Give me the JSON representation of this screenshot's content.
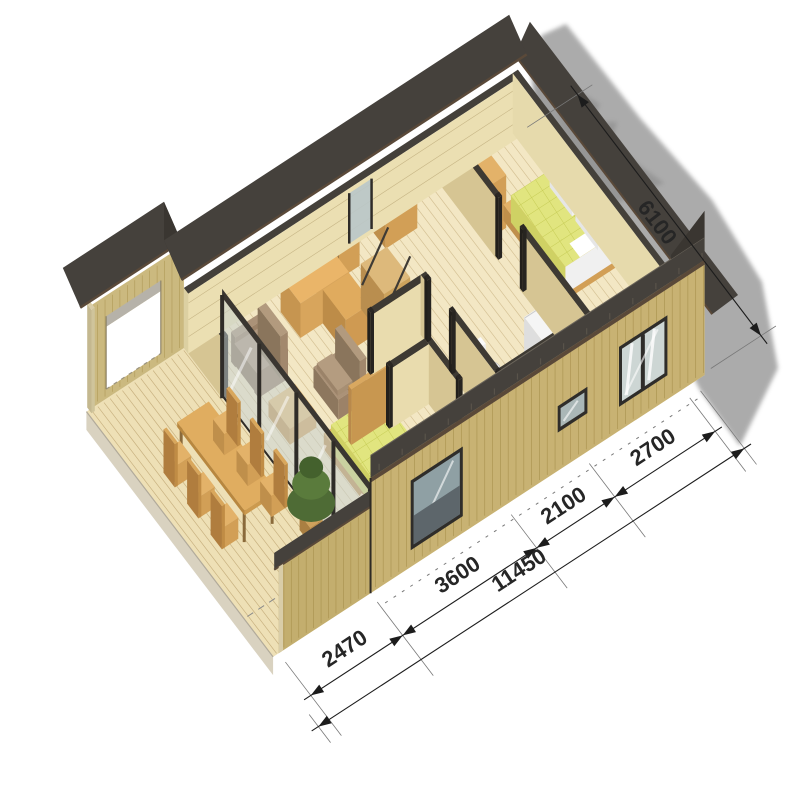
{
  "figure": {
    "title": "isometric cutaway floor plan of a single-storey house",
    "background_color": "#ffffff",
    "dims": {
      "side": "6100",
      "total": "11450",
      "segments": [
        "2470",
        "3600",
        "2100",
        "2700"
      ]
    },
    "palette": {
      "roof": "#45413c",
      "roof_dark": "#3a3631",
      "fascia_brown": "#5a4939",
      "siding": "#c8b273",
      "siding_line": "#a8914d",
      "interior_floor": "#f3e7c4",
      "floor_line": "#c9b282",
      "terrace_deck": "#eee0b6",
      "deck_line": "#bfa673",
      "mattress": "#e1e57f",
      "mattress_line": "#c6cc55",
      "furniture_wood_top": "#e3b269",
      "furniture_wood_left": "#bf8f4b",
      "furniture_wood_right": "#d29f56",
      "upholstery_top": "#ab9278",
      "upholstery_left": "#8d775e",
      "upholstery_right": "#9c8268",
      "wall_cap": "#3e3a33",
      "wall_face_left": "#d6c593",
      "wall_face_right": "#e9dcae",
      "glass": "#c6d2d2",
      "shadow": "#a0a0a0",
      "dimension_text": "#262626",
      "plant_green": "#4e6b35"
    }
  }
}
